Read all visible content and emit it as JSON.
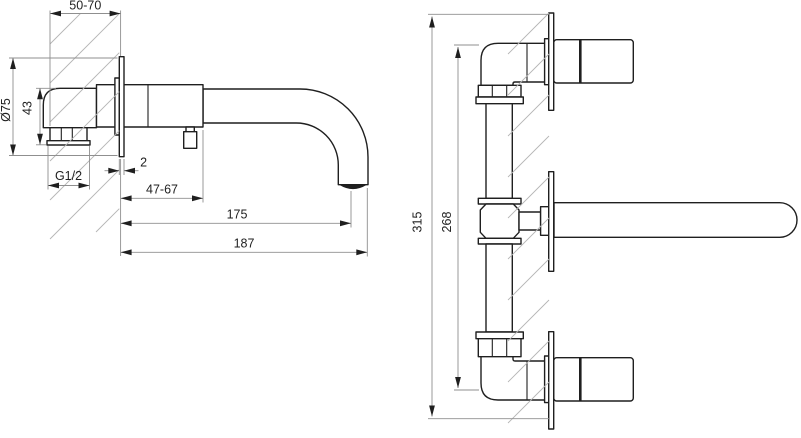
{
  "drawing": {
    "type": "technical-dimension-drawing",
    "subject": "wall-mounted-basin-mixer-faucet",
    "views": {
      "side": {
        "label": "side-section-view",
        "dims": {
          "install_depth": "50-70",
          "rosette_diameter": "Ø75",
          "body_height": "43",
          "thread": "G1/2",
          "rosette_thickness": "2",
          "wall_to_body": "47-67",
          "spout_reach": "175",
          "overall_reach": "187"
        }
      },
      "front": {
        "label": "front-view",
        "dims": {
          "overall_height": "315",
          "connection_span": "268"
        }
      }
    },
    "colors": {
      "background": "#ffffff",
      "outline": "#1f1f1f",
      "dimension_line": "#8f8f8f",
      "hatch": "#b5b5b5",
      "text": "#1f1f1f"
    }
  }
}
